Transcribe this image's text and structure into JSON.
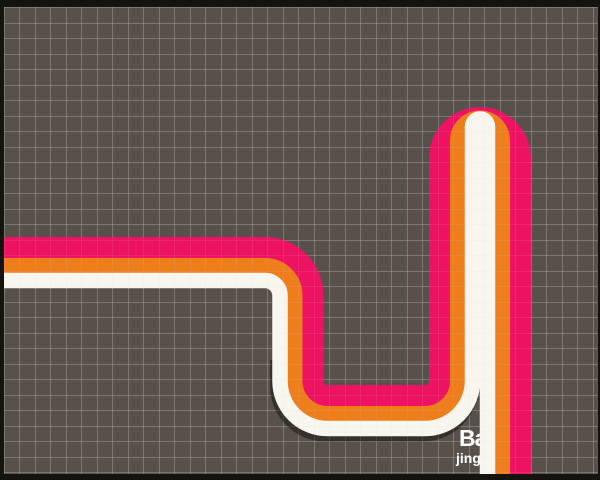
{
  "scene": {
    "width": 600,
    "height": 480,
    "background_color": "#57504b",
    "border_color": "#15130f",
    "border_widths": {
      "top": 7,
      "right": 2,
      "bottom": 6,
      "left": 4
    },
    "grid": {
      "cell_size": 15.5,
      "offset_x": 4,
      "offset_y": 7.5,
      "line_color": "#d6d0c7",
      "line_opacity_under": 0.5,
      "line_opacity_over": 0.22
    }
  },
  "route": {
    "description": "three parallel stripes routed on grid paper: left edge -> east -> south -> east -> north hairpin at top right -> south to bottom edge",
    "paths": [
      {
        "name": "white-stripe-shadow",
        "color": "#2e2a26",
        "width": 16,
        "opacity": 0.85,
        "offset": [
          -2,
          5
        ],
        "points": [
          [
            280,
            355
          ],
          [
            280,
            428.5
          ],
          [
            472.5,
            428.5
          ],
          [
            472.5,
            395
          ]
        ],
        "radii": [
          47.5,
          47.5
        ]
      },
      {
        "name": "pink-stripe",
        "color": "#ee1263",
        "width": 24,
        "opacity": 1,
        "offset": [
          0,
          0
        ],
        "points": [
          [
            -6,
            249
          ],
          [
            311.5,
            249
          ],
          [
            311.5,
            397
          ],
          [
            441,
            397
          ],
          [
            441,
            119
          ],
          [
            519,
            119
          ],
          [
            519,
            482
          ]
        ],
        "radii": [
          46.5,
          16,
          16,
          39,
          39
        ]
      },
      {
        "name": "orange-stripe",
        "color": "#ee7d1b",
        "width": 17,
        "opacity": 1,
        "offset": [
          0,
          0
        ],
        "points": [
          [
            -6,
            266.5
          ],
          [
            294,
            266.5
          ],
          [
            294,
            414.5
          ],
          [
            458.5,
            414.5
          ],
          [
            458.5,
            119
          ],
          [
            501.5,
            119
          ],
          [
            501.5,
            482
          ]
        ],
        "radii": [
          29,
          33.5,
          33.5,
          21.5,
          21.5
        ]
      },
      {
        "name": "white-stripe",
        "color": "#f8f6ef",
        "width": 15.5,
        "opacity": 1,
        "offset": [
          0,
          0
        ],
        "points": [
          [
            -6,
            280.5
          ],
          [
            280,
            280.5
          ],
          [
            280,
            428.5
          ],
          [
            472.5,
            428.5
          ],
          [
            472.5,
            119
          ],
          [
            487.5,
            119
          ],
          [
            487.5,
            482
          ]
        ],
        "radii": [
          15,
          47.5,
          47.5,
          7.5,
          7.5
        ]
      }
    ]
  },
  "watermark": {
    "line1": "Ba",
    "line2": "jing",
    "color": "#ffffff",
    "line1_pos": [
      459,
      446
    ],
    "line2_pos": [
      456,
      463
    ]
  }
}
